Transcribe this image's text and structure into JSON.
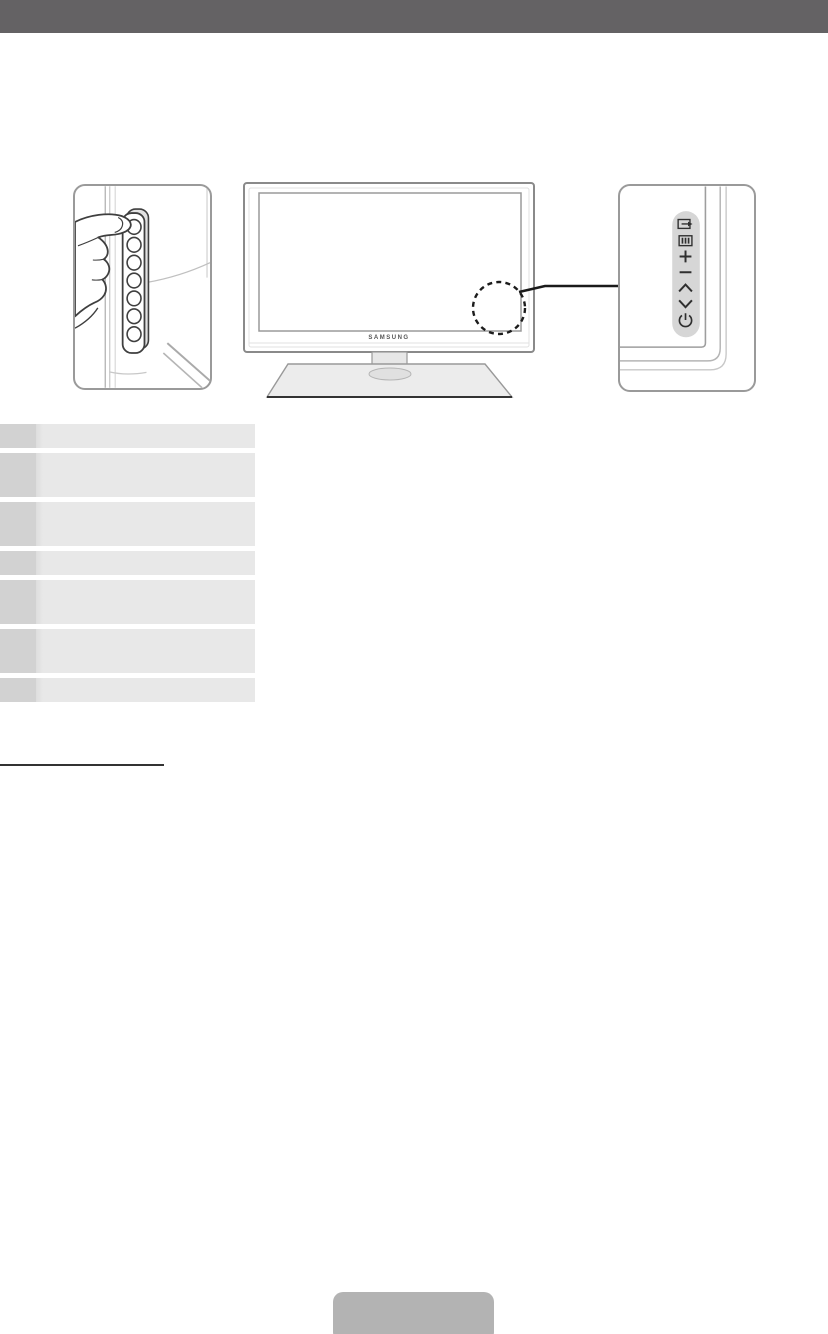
{
  "colors": {
    "header_bg": "#646264",
    "frame_border": "#9a9a9a",
    "drawing_line": "#3f3f3f",
    "light_line": "#b5b5b5",
    "strip_bg": "#d6d6d6",
    "icon_color": "#2f2f2f",
    "table_label_bg": "#d2d2d2",
    "table_desc_bg": "#e8e8e8",
    "rule_color": "#333333",
    "bottom_button_bg": "#b3b3b3"
  },
  "header": {
    "text": ""
  },
  "tv": {
    "brand": "SAMSUNG"
  },
  "control_panel": {
    "buttons": [
      {
        "name": "source",
        "icon": "source-icon"
      },
      {
        "name": "menu",
        "icon": "menu-icon"
      },
      {
        "name": "volume-up",
        "icon": "plus-icon"
      },
      {
        "name": "volume-down",
        "icon": "minus-icon"
      },
      {
        "name": "channel-up",
        "icon": "chevron-up-icon"
      },
      {
        "name": "channel-down",
        "icon": "chevron-down-icon"
      },
      {
        "name": "power",
        "icon": "power-icon"
      }
    ]
  },
  "side_panel": {
    "button_count": 7
  },
  "table": {
    "rows": [
      {
        "label": "",
        "description": "",
        "tall": false
      },
      {
        "label": "",
        "description": "",
        "tall": true
      },
      {
        "label": "",
        "description": "",
        "tall": true
      },
      {
        "label": "",
        "description": "",
        "tall": false
      },
      {
        "label": "",
        "description": "",
        "tall": true
      },
      {
        "label": "",
        "description": "",
        "tall": true
      },
      {
        "label": "",
        "description": "",
        "tall": false
      }
    ]
  },
  "rule": {
    "text": ""
  },
  "bottom_button": {
    "label": ""
  }
}
